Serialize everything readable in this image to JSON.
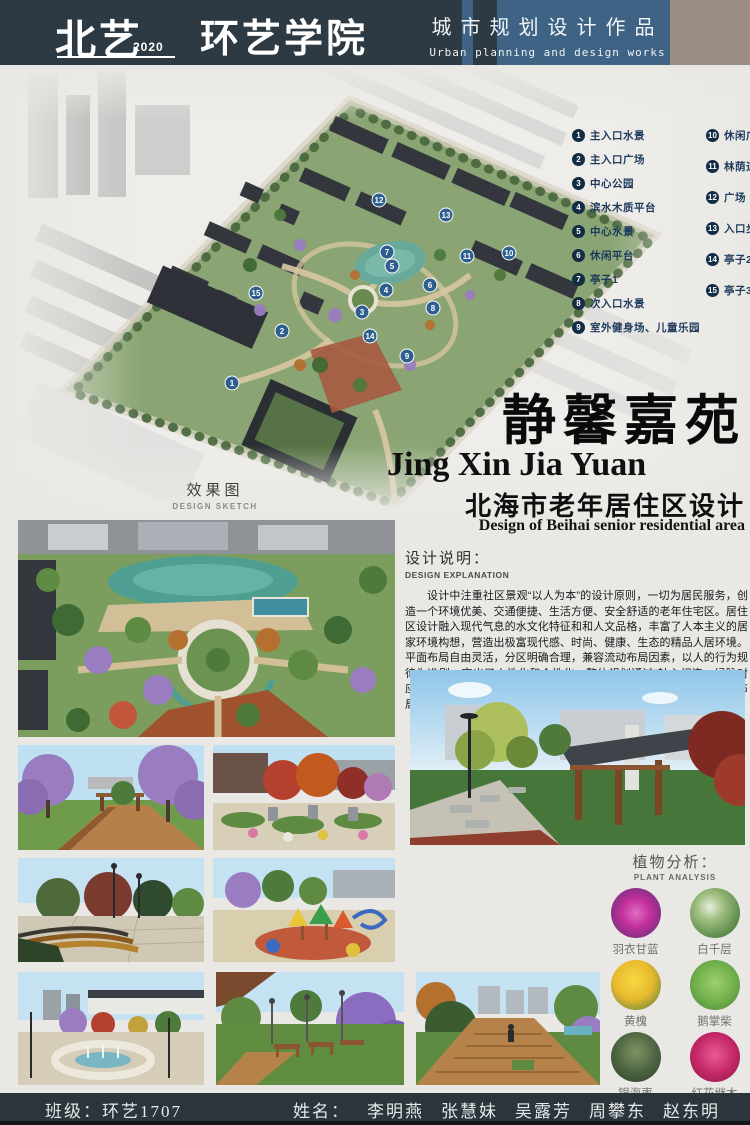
{
  "header": {
    "logo": {
      "name": "北艺",
      "year": "2020",
      "school": "环艺学院"
    },
    "title_cn": "城市规划设计作品",
    "title_en": "Urban planning and design works"
  },
  "master_plan": {
    "caption_cn": "效果图",
    "caption_en": "DESIGN SKETCH",
    "legend": {
      "items": [
        {
          "num": "1",
          "label": "主入口水景"
        },
        {
          "num": "2",
          "label": "主入口广场"
        },
        {
          "num": "3",
          "label": "中心公园"
        },
        {
          "num": "4",
          "label": "滨水木质平台"
        },
        {
          "num": "5",
          "label": "中心水景"
        },
        {
          "num": "6",
          "label": "休闲平台"
        },
        {
          "num": "7",
          "label": "亭子1"
        },
        {
          "num": "8",
          "label": "次入口水景"
        },
        {
          "num": "9",
          "label": "室外健身场、儿童乐园"
        },
        {
          "num": "10",
          "label": "休闲广场"
        },
        {
          "num": "11",
          "label": "林荫道"
        },
        {
          "num": "12",
          "label": "广场"
        },
        {
          "num": "13",
          "label": "入口步道广场"
        },
        {
          "num": "14",
          "label": "亭子2、创意廊架"
        },
        {
          "num": "15",
          "label": "亭子3"
        }
      ]
    }
  },
  "title_block": {
    "title_cn": "静馨嘉苑",
    "title_pinyin": "Jing Xin Jia Yuan",
    "subtitle_cn": "北海市老年居住区设计",
    "subtitle_en": "Design of Beihai senior residential area"
  },
  "design_explanation": {
    "heading_cn": "设计说明：",
    "heading_en": "DESIGN EXPLANATION",
    "body": "设计中注重社区景观“以人为本”的设计原则，一切为居民服务，创造一个环境优美、交通便捷、生活方便、安全舒适的老年住宅区。居住区设计融入现代气息的水文化特征和和人文品格，丰富了人本主义的居家环境构想，营造出极富现代感、时尚、健康、生态的精品人居环境。平面布局自由灵活，分区明确合理，兼容流动布局因素，以人的行为规律为准则，突出了人性化和个性化。整体规划通过“轴心相连，绿脉对应”的景观布局分析，将社区环境规划为以中心水景为核心的向心式布局。"
  },
  "plant_analysis": {
    "heading_cn": "植物分析：",
    "heading_en": "PLANT ANALYSIS",
    "plants": [
      {
        "name": "羽衣甘蓝",
        "color": "#c2309b"
      },
      {
        "name": "白千层",
        "color": "#5f8c4e"
      },
      {
        "name": "黄槐",
        "color": "#e8b92e"
      },
      {
        "name": "鹅掌柴",
        "color": "#6fae4b"
      },
      {
        "name": "银海枣",
        "color": "#4a6140"
      },
      {
        "name": "红花继木",
        "color": "#c22664"
      }
    ]
  },
  "footer": {
    "class_text": "班级：环艺1707",
    "names_prefix": "姓名：",
    "names": [
      "李明燕",
      "张慧妹",
      "吴露芳",
      "周攀东",
      "赵东明"
    ]
  },
  "colors": {
    "header_bg": "#2d3a43",
    "header_blue": "#3e6384",
    "header_tan": "#9c8d83",
    "page_bg": "#e9e8e4",
    "legend_text": "#1d3a5c",
    "footer_bg": "#2b353b"
  }
}
